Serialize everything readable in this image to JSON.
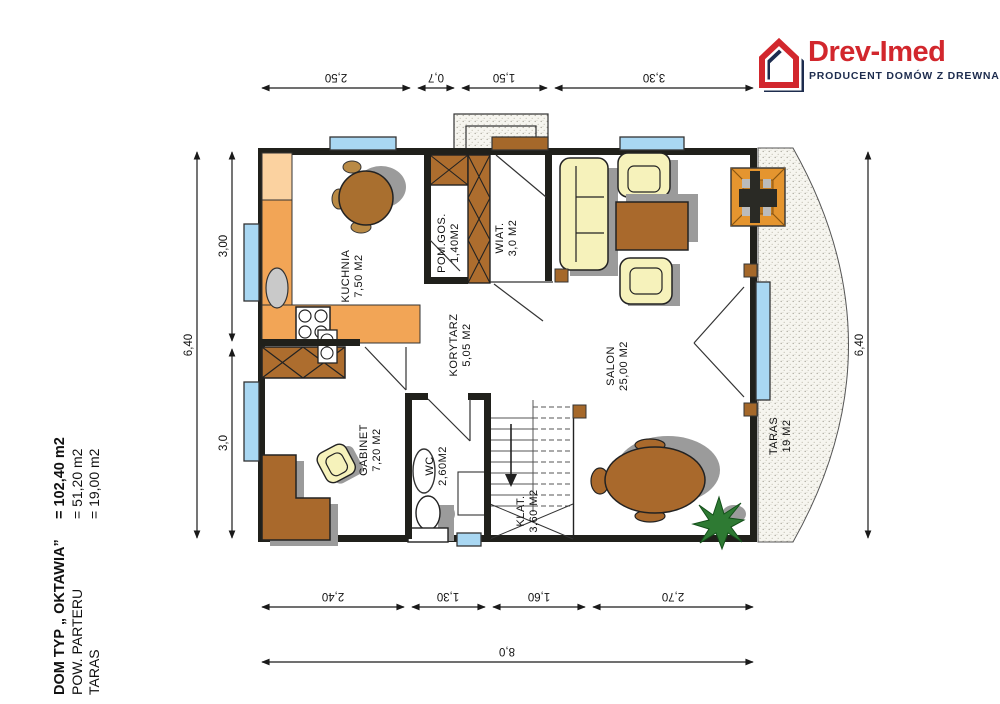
{
  "logo": {
    "brand": "Drev-Imed",
    "tagline": "PRODUCENT DOMÓW Z DREWNA",
    "brand_color": "#d2272d",
    "navy_color": "#1d2c4e"
  },
  "title_block": {
    "line1": {
      "label": "DOM TYP „ OKTAWIA”",
      "value": "= 102,40 m2"
    },
    "line2": {
      "label": "POW. PARTERU",
      "value": "= 51,20 m2"
    },
    "line3": {
      "label": "TARAS",
      "value": "= 19,00 m2"
    }
  },
  "rooms": {
    "kuchnia": {
      "name": "KUCHNIA",
      "area": "7,50 M2"
    },
    "pom_gos": {
      "name": "POM.GOS.",
      "area": "1,40M2"
    },
    "wiat": {
      "name": "WIAT.",
      "area": "3,0 M2"
    },
    "korytarz": {
      "name": "KORYTARZ",
      "area": "5,05 M2"
    },
    "salon": {
      "name": "SALON",
      "area": "25,00 M2"
    },
    "gabinet": {
      "name": "GABINET",
      "area": "7,20 M2"
    },
    "wc": {
      "name": "WC",
      "area": "2,60M2"
    },
    "klatka": {
      "name": "KLAT.",
      "area": "3,60 M2"
    },
    "taras": {
      "name": "TARAS",
      "area": "19 M2"
    }
  },
  "dimensions": {
    "top": [
      "2,50",
      "0,7",
      "1,50",
      "3,30"
    ],
    "bottom": [
      "2,40",
      "1,30",
      "1,60",
      "2,70"
    ],
    "bottom_total": "8,0",
    "left_outer": "6,40",
    "left_inner": [
      "3,00",
      "3,0"
    ],
    "right": "6,40"
  }
}
